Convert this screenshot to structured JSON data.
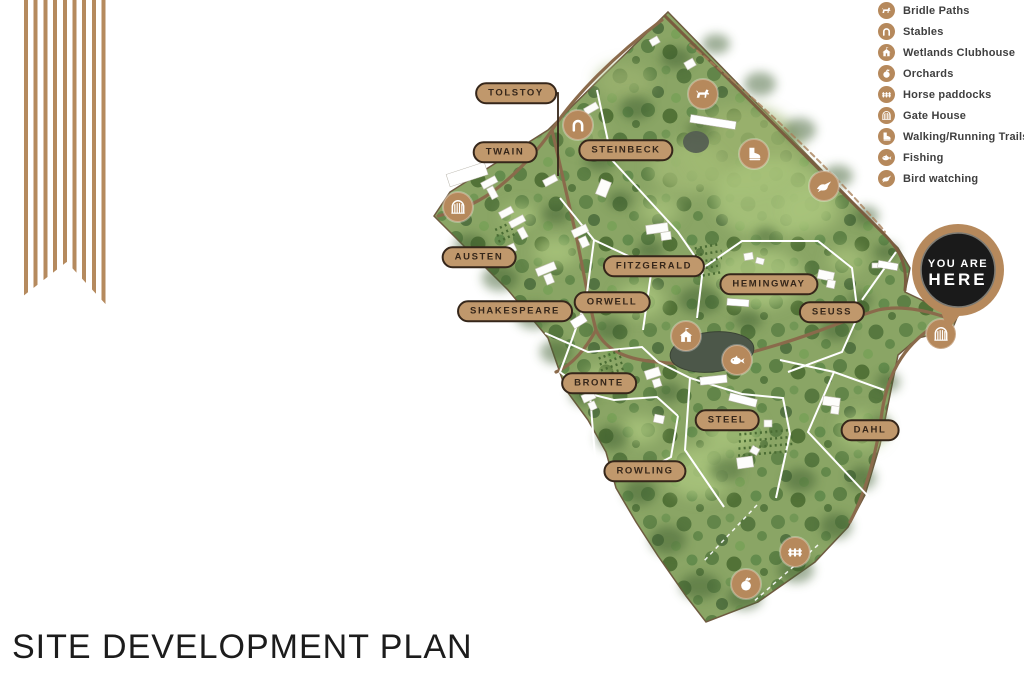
{
  "title": "SITE DEVELOPMENT PLAN",
  "legend": {
    "items": [
      {
        "label": "Bridle Paths",
        "icon": "horse-icon"
      },
      {
        "label": "Stables",
        "icon": "horseshoe-icon"
      },
      {
        "label": "Wetlands Clubhouse",
        "icon": "clubhouse-icon"
      },
      {
        "label": "Orchards",
        "icon": "apple-icon"
      },
      {
        "label": "Horse paddocks",
        "icon": "fence-icon"
      },
      {
        "label": "Gate House",
        "icon": "gate-icon"
      },
      {
        "label": "Walking/Running Trails",
        "icon": "boot-icon"
      },
      {
        "label": "Fishing",
        "icon": "fish-icon"
      },
      {
        "label": "Bird watching",
        "icon": "bird-icon"
      }
    ]
  },
  "map": {
    "plots": [
      "TOLSTOY",
      "TWAIN",
      "STEINBECK",
      "AUSTEN",
      "FITZGERALD",
      "ORWELL",
      "SHAKESPEARE",
      "HEMINGWAY",
      "SEUSS",
      "BRONTE",
      "STEEL",
      "ROWLING",
      "DAHL"
    ],
    "you_are_here": {
      "line1": "YOU ARE",
      "line2": "HERE"
    }
  },
  "colors": {
    "accent_tan": "#b6895c",
    "pill_tan": "#c0986c",
    "outline_brown": "#35261a",
    "badge_black": "#1a1a1a",
    "land_green": "#8aa565",
    "road_brown": "#8a6a4b"
  }
}
